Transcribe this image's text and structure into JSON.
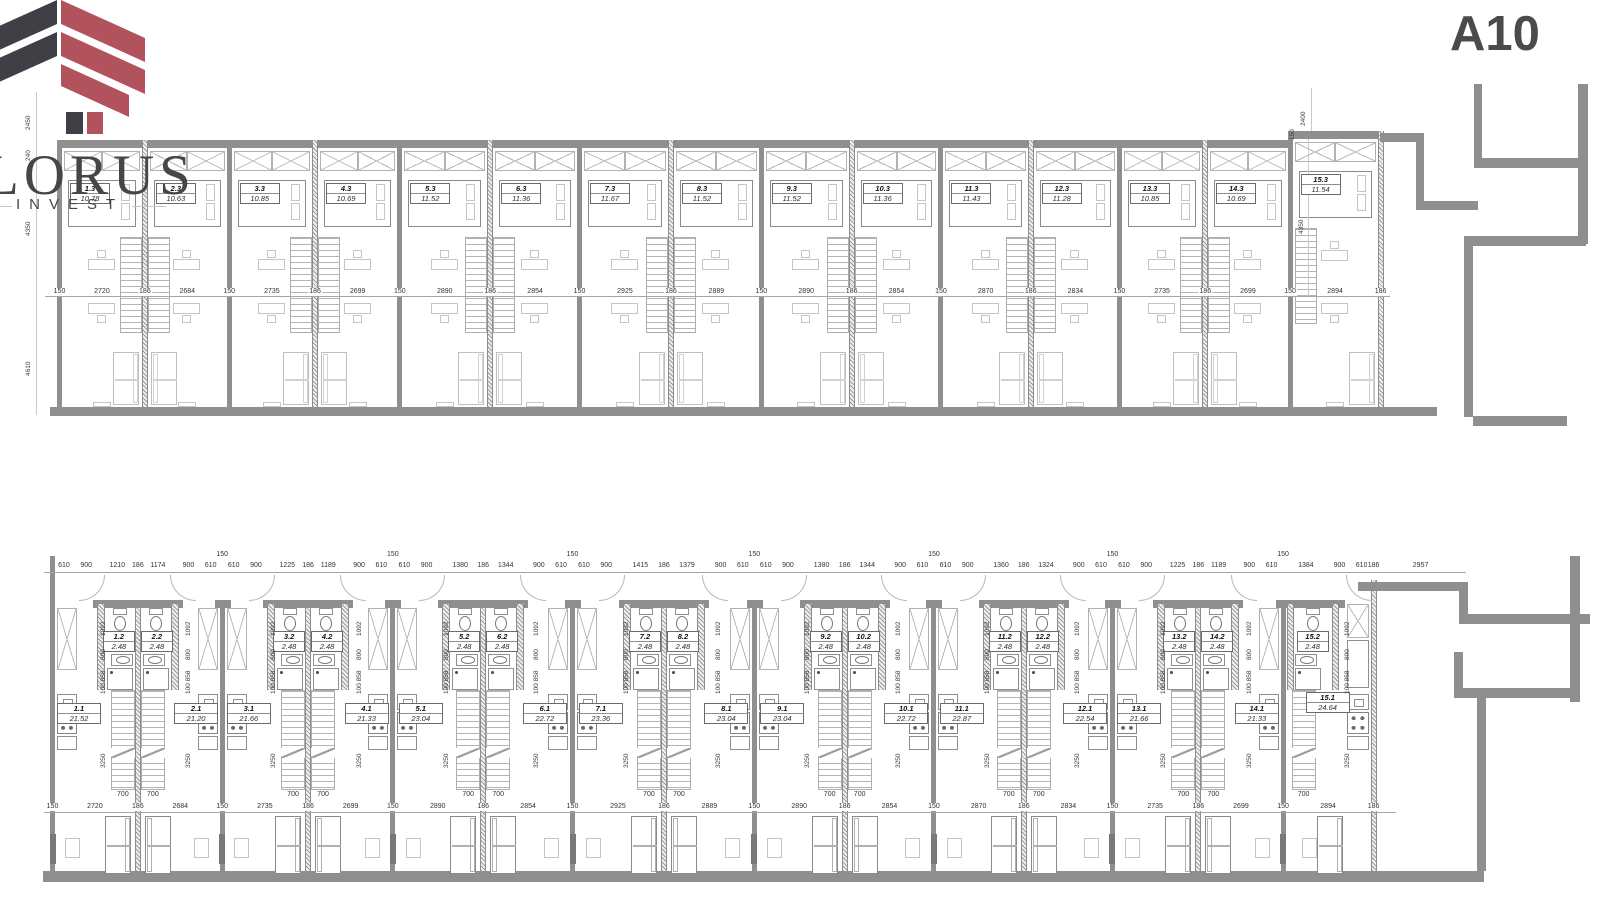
{
  "branding": {
    "name": "LORUS",
    "subtitle": "INVEST",
    "logo_dark_color": "#403f45",
    "logo_red_color": "#b2525c"
  },
  "sheet": {
    "code": "A10"
  },
  "colors": {
    "wall_gray": "#8f8f8f",
    "dim_text": "#333333",
    "light_line": "#c5c5c5"
  },
  "upper_plan": {
    "units": [
      {
        "id": "1.3",
        "area": "10.78"
      },
      {
        "id": "2.3",
        "area": "10.63"
      },
      {
        "id": "3.3",
        "area": "10.85"
      },
      {
        "id": "4.3",
        "area": "10.69"
      },
      {
        "id": "5.3",
        "area": "11.52"
      },
      {
        "id": "6.3",
        "area": "11.36"
      },
      {
        "id": "7.3",
        "area": "11.67"
      },
      {
        "id": "8.3",
        "area": "11.52"
      },
      {
        "id": "9.3",
        "area": "11.52"
      },
      {
        "id": "10.3",
        "area": "11.36"
      },
      {
        "id": "11.3",
        "area": "11.43"
      },
      {
        "id": "12.3",
        "area": "11.28"
      },
      {
        "id": "13.3",
        "area": "10.85"
      },
      {
        "id": "14.3",
        "area": "10.69"
      },
      {
        "id": "15.3",
        "area": "11.54"
      }
    ],
    "mid_dims": [
      "150",
      "2720",
      "186",
      "2684",
      "150",
      "2735",
      "186",
      "2699",
      "150",
      "2890",
      "186",
      "2854",
      "150",
      "2925",
      "186",
      "2889",
      "150",
      "2890",
      "186",
      "2854",
      "150",
      "2870",
      "186",
      "2834",
      "150",
      "2735",
      "186",
      "2699",
      "150",
      "2894",
      "186"
    ],
    "left_dims": [
      "2450",
      "240",
      "4350",
      "4610"
    ],
    "right_dims": [
      "2400",
      "150",
      "4350"
    ]
  },
  "lower_plan": {
    "units": [
      {
        "room_id": "1.1",
        "room_area": "21.52",
        "bath_id": "1.2",
        "bath_area": "2.48"
      },
      {
        "room_id": "2.1",
        "room_area": "21.20",
        "bath_id": "2.2",
        "bath_area": "2.48"
      },
      {
        "room_id": "3.1",
        "room_area": "21.66",
        "bath_id": "3.2",
        "bath_area": "2.48"
      },
      {
        "room_id": "4.1",
        "room_area": "21.33",
        "bath_id": "4.2",
        "bath_area": "2.48"
      },
      {
        "room_id": "5.1",
        "room_area": "23.04",
        "bath_id": "5.2",
        "bath_area": "2.48"
      },
      {
        "room_id": "6.1",
        "room_area": "22.72",
        "bath_id": "6.2",
        "bath_area": "2.48"
      },
      {
        "room_id": "7.1",
        "room_area": "23.36",
        "bath_id": "7.2",
        "bath_area": "2.48"
      },
      {
        "room_id": "8.1",
        "room_area": "23.04",
        "bath_id": "8.2",
        "bath_area": "2.48"
      },
      {
        "room_id": "9.1",
        "room_area": "23.04",
        "bath_id": "9.2",
        "bath_area": "2.48"
      },
      {
        "room_id": "10.1",
        "room_area": "22.72",
        "bath_id": "10.2",
        "bath_area": "2.48"
      },
      {
        "room_id": "11.1",
        "room_area": "22.87",
        "bath_id": "11.2",
        "bath_area": "2.48"
      },
      {
        "room_id": "12.1",
        "room_area": "22.54",
        "bath_id": "12.2",
        "bath_area": "2.48"
      },
      {
        "room_id": "13.1",
        "room_area": "21.66",
        "bath_id": "13.2",
        "bath_area": "2.48"
      },
      {
        "room_id": "14.1",
        "room_area": "21.33",
        "bath_id": "14.2",
        "bath_area": "2.48"
      },
      {
        "room_id": "15.1",
        "room_area": "24.64",
        "bath_id": "15.2",
        "bath_area": "2.48"
      }
    ],
    "pair_top_dims": [
      [
        "610",
        "900",
        "1210",
        "186",
        "1174",
        "900",
        "610"
      ],
      [
        "610",
        "900",
        "1225",
        "186",
        "1189",
        "900",
        "610"
      ],
      [
        "610",
        "900",
        "1380",
        "186",
        "1344",
        "900",
        "610"
      ],
      [
        "610",
        "900",
        "1415",
        "186",
        "1379",
        "900",
        "610"
      ],
      [
        "610",
        "900",
        "1380",
        "186",
        "1344",
        "900",
        "610"
      ],
      [
        "610",
        "900",
        "1360",
        "186",
        "1324",
        "900",
        "610"
      ],
      [
        "610",
        "900",
        "1225",
        "186",
        "1189",
        "900",
        "610"
      ]
    ],
    "end_top_dims": [
      "1384",
      "900",
      "610"
    ],
    "neighbor_top_dims": [
      "186",
      "2957"
    ],
    "pair_wall_dim": "150",
    "bottom_dims": [
      "150",
      "2720",
      "186",
      "2684",
      "150",
      "2735",
      "186",
      "2699",
      "150",
      "2890",
      "186",
      "2854",
      "150",
      "2925",
      "186",
      "2889",
      "150",
      "2890",
      "186",
      "2854",
      "150",
      "2870",
      "186",
      "2834",
      "150",
      "2735",
      "186",
      "2699",
      "150",
      "2894",
      "186"
    ],
    "side_dims": [
      "1092",
      "800",
      "100 858",
      "3250"
    ],
    "stair_dim": "700"
  }
}
